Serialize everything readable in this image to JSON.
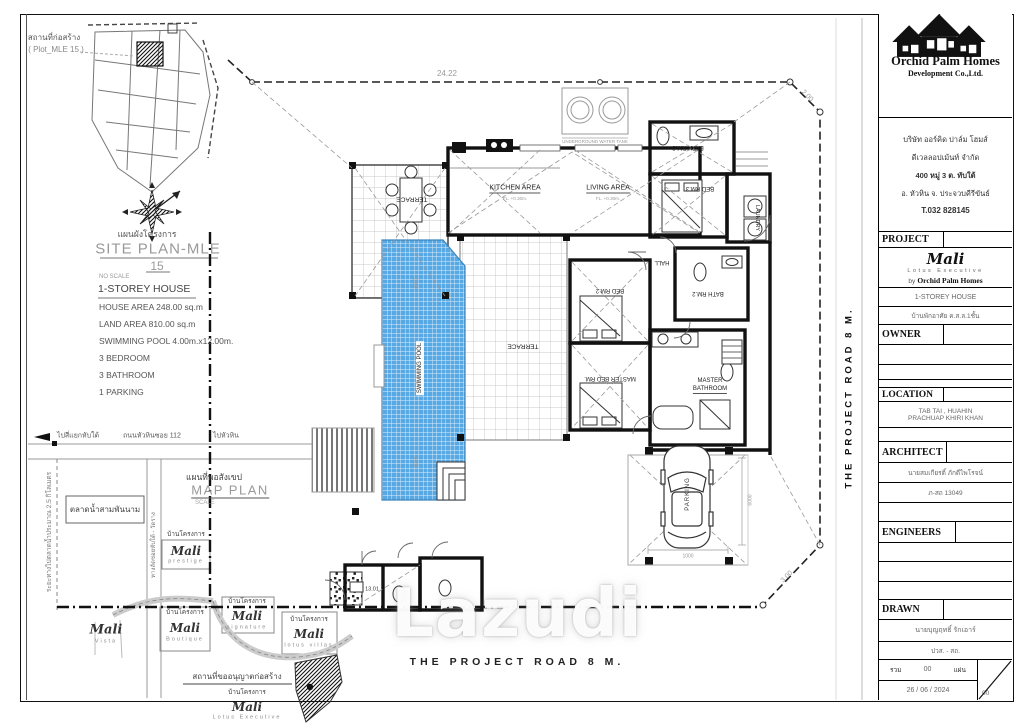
{
  "watermark": "Lazudi",
  "road": {
    "bottom_label": "THE PROJECT ROAD 8 M.",
    "right_label": "THE PROJECT ROAD 8 M."
  },
  "site_plan": {
    "location_line1": "สถานที่ก่อสร้าง",
    "location_line2": "( Plot_MLE 15 )",
    "title_thai": "แผนผังโครงการ",
    "title_en": "SITE PLAN-MLE",
    "title_num": "15",
    "scale_note": "NO SCALE"
  },
  "house_info": {
    "title": "1-STOREY HOUSE",
    "lines": [
      "HOUSE AREA  248.00 sq.m",
      "LAND AREA  810.00 sq.m",
      "SWIMMING POOL 4.00m.x12.00m.",
      "3 BEDROOM",
      "3 BATHROOM",
      "1 PARKING"
    ]
  },
  "map_plan": {
    "title_thai": "แผนที่พอสังเขป",
    "title_en": "MAP PLAN",
    "scale_label": "SCALE",
    "dir_left": "ไปสี่แยกหับใต้",
    "road_name": "ถนนหัวหินซอย 112",
    "dir_right": "ไปหัวหิน",
    "distance_note": "ระยะทางไปตลาดน้ำประมาณ 2.5 กิโลเมตร",
    "market_label": "ตลาดน้ำสามพันนาม",
    "side_road_label": "ทางลัดซอยหับใต้ - วัดราง",
    "project_house_label": "บ้านโครงการ",
    "permit_label": "สถานที่ขออนุญาตก่อสร้าง",
    "projects": {
      "prestige": {
        "name": "Mali",
        "sub": "prestige"
      },
      "vista": {
        "name": "Mali",
        "sub": "Vista"
      },
      "boutique": {
        "name": "Mali",
        "sub": "Boutique"
      },
      "signature": {
        "name": "Mali",
        "sub": "signature"
      },
      "lotus_villas": {
        "name": "Mali",
        "sub": "lotus villas"
      },
      "lotus_executive": {
        "name": "Mali",
        "sub": "Lotus Executive"
      }
    }
  },
  "floor_plan": {
    "rooms": {
      "terrace_top": "TERRACE",
      "kitchen": "KITCHEN AREA",
      "living": "LIVING AREA",
      "bath3": "BATH RM.3",
      "bed3": "BED RM.3",
      "laundry": "LAUNDRY",
      "hall": "HALL",
      "bath2": "BATH RM.2",
      "bed2": "BED RM.2",
      "terrace_pool": "TERRACE",
      "master_bed": "MASTER BED RM.",
      "master_bath_1": "MASTER",
      "master_bath_2": "BATHROOM",
      "pool": "SWIMMING POOL",
      "parking": "PARKING"
    },
    "floor_note": "FL. +0.30m.",
    "tank_label": "UNDERGROUND WATER TANK",
    "dims": {
      "boundary_top": "24.22",
      "boundary_ne": "2.00",
      "boundary_se": "3.00",
      "pool_width": "4000",
      "parking_width": "1000",
      "parking_depth": "6000",
      "room_no": "13.01"
    }
  },
  "title_block": {
    "company": "Orchid Palm Homes",
    "company_sub": "Development Co.,Ltd.",
    "address": {
      "l1": "บริษัท ออร์คิด ปาล์ม โฮมส์",
      "l2": "ดีเวลลอปเม้นท์ จำกัด",
      "l3": "400 หมู่ 3 ต. ทับใต้",
      "l4": "อ. หัวหิน จ. ประจวบคีรีขันธ์",
      "l5": "T.032 828145"
    },
    "project_label": "PROJECT",
    "project_name": "Mali",
    "project_sub": "Lotus Executive",
    "project_by": "by",
    "project_by_name": "Orchid Palm Homes",
    "project_type": "1-STOREY HOUSE",
    "project_type_thai": "บ้านพักอาศัย ค.ส.ล.1ชั้น",
    "owner_label": "OWNER",
    "location_label": "LOCATION",
    "location_value1": "TAB TAI , HUAHIN",
    "location_value2": "PRACHUAP KHIRI KHAN",
    "architect_label": "ARCHITECT",
    "architect_name": "นายสมเกียรติ์ ภักดีไพโรจน์",
    "architect_license": "ภ-สถ 13049",
    "engineers_label": "ENGINEERS",
    "drawn_label": "DRAWN",
    "drawn_name": "นายบุญฤทธิ์ รักเอาร์",
    "drawn_title": "ปวส. - สถ.",
    "sheet_total_label": "รวม",
    "sheet_total": "00",
    "sheet_unit": "แผ่น",
    "date": "26 / 06 / 2024",
    "sheet_no": "00"
  }
}
